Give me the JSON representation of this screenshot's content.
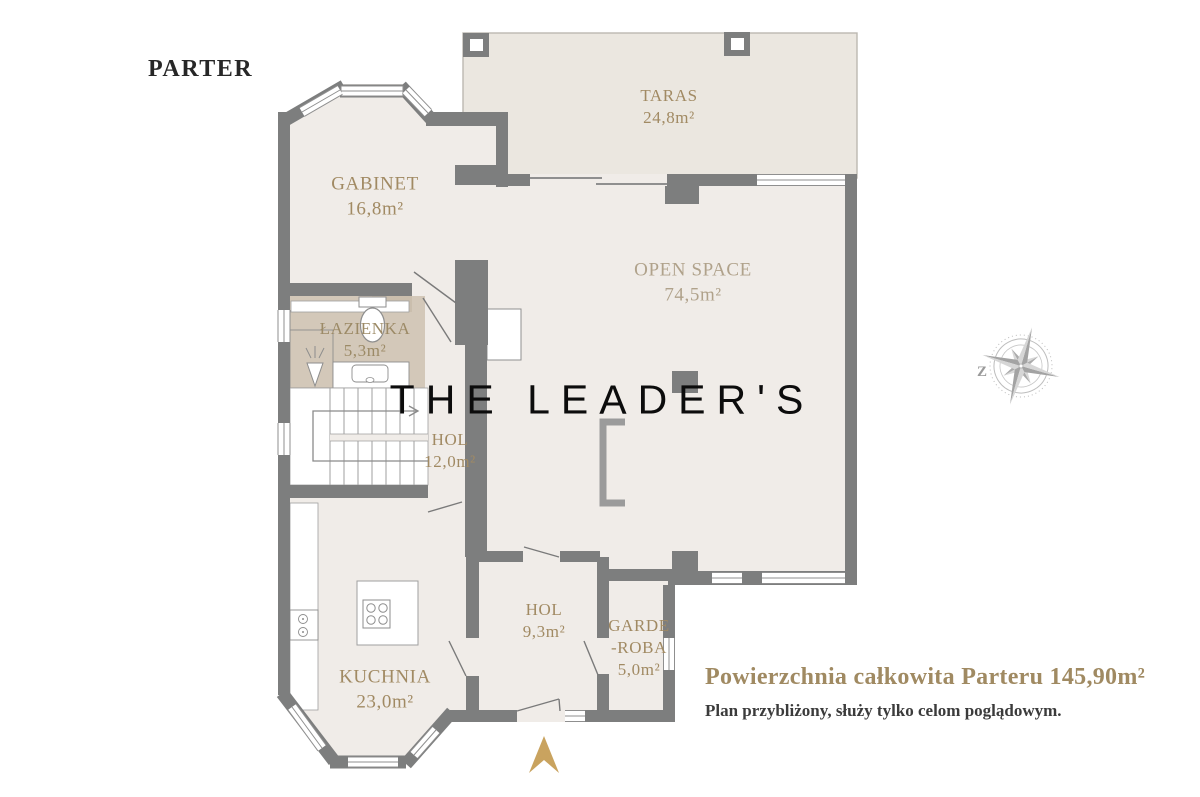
{
  "title": "PARTER",
  "watermark": "THE LEADER'S",
  "rooms": {
    "taras": {
      "name": "TARAS",
      "area": "24,8m²"
    },
    "gabinet": {
      "name": "GABINET",
      "area": "16,8m²"
    },
    "open_space": {
      "name": "OPEN SPACE",
      "area": "74,5m²"
    },
    "lazienka": {
      "name": "ŁAZIENKA",
      "area": "5,3m²"
    },
    "hol": {
      "name": "HOL",
      "area": "12,0m²"
    },
    "kuchnia": {
      "name": "KUCHNIA",
      "area": "23,0m²"
    },
    "hol2": {
      "name": "HOL",
      "area": "9,3m²"
    },
    "garderoba": {
      "name_line1": "GARDE",
      "name_line2": "-ROBA",
      "area": "5,0m²"
    }
  },
  "footer": {
    "total": "Powierzchnia całkowita Parteru 145,90m²",
    "disclaimer": "Plan przybliżony, służy tylko celom poglądowym."
  },
  "compass": {
    "west_label": "Z"
  },
  "palette": {
    "wall_gray": "#7d7e7e",
    "floor": "#f0ece8",
    "terrace": "#ebe7e0",
    "bathroom": "#d3c8b9",
    "label_tan": "#a18a63",
    "entrance_arrow_gold": "#c9a35f"
  }
}
